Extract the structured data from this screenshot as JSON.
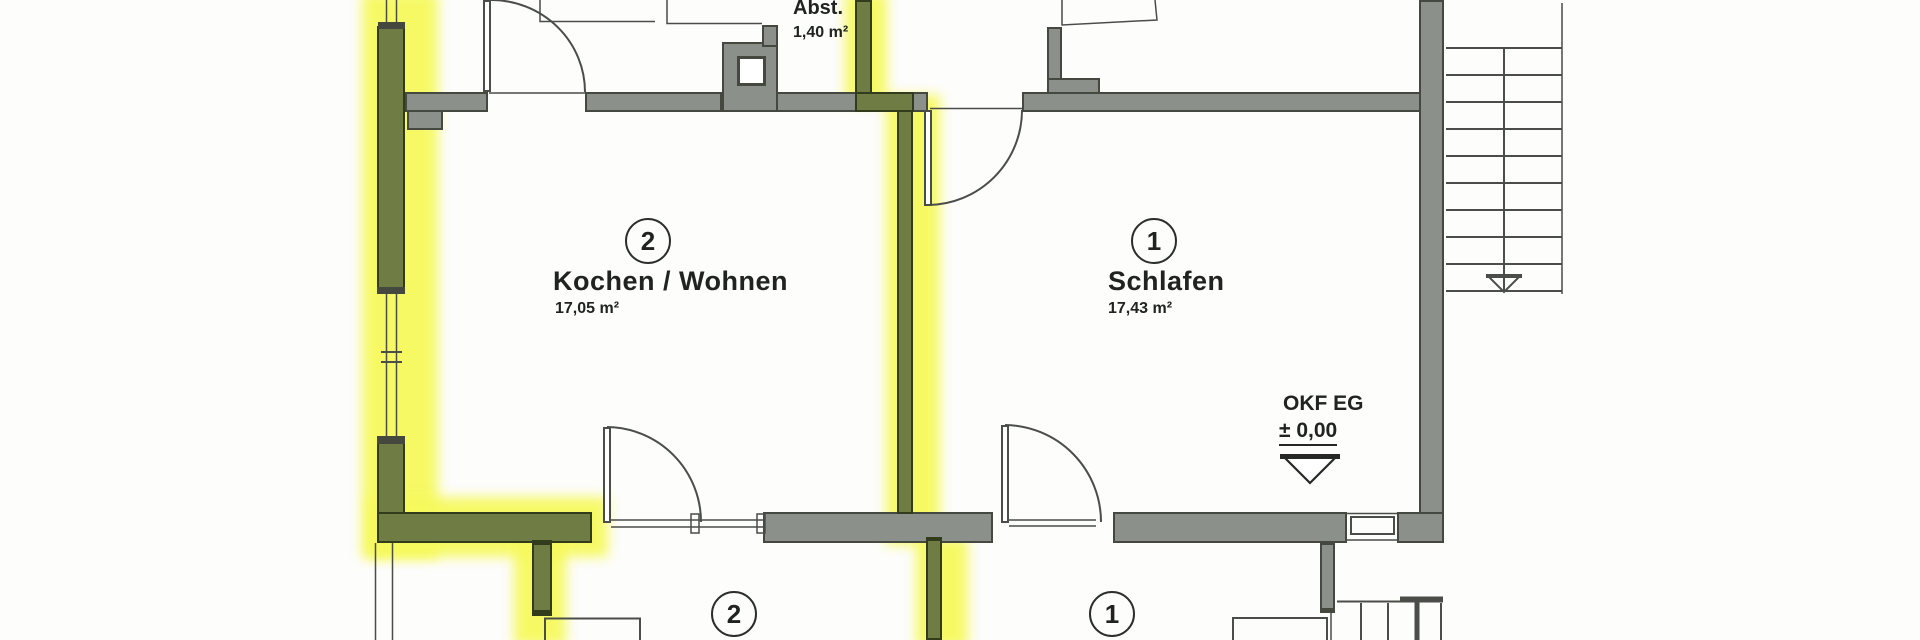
{
  "floorplan": {
    "rooms": {
      "abst": {
        "name": "Abst.",
        "area": "1,40 m²"
      },
      "kochen_wohnen": {
        "number": "2",
        "name": "Kochen / Wohnen",
        "area": "17,05 m²"
      },
      "schlafen": {
        "number": "1",
        "name": "Schlafen",
        "area": "17,43 m²"
      },
      "lower_left": {
        "number": "2"
      },
      "lower_right": {
        "number": "1"
      }
    },
    "level_marker": {
      "label": "OKF EG",
      "value": "± 0,00"
    },
    "colors": {
      "wall_gray": "#8b908b",
      "wall_outline": "#45483f",
      "highlighted_wall_fill": "#6f7d45",
      "highlighted_wall_outline": "#323c1c",
      "highlight_glow": "#f6f95c",
      "thin_line": "#4a4d48",
      "text": "#20231f",
      "background": "#fdfdfc"
    }
  }
}
